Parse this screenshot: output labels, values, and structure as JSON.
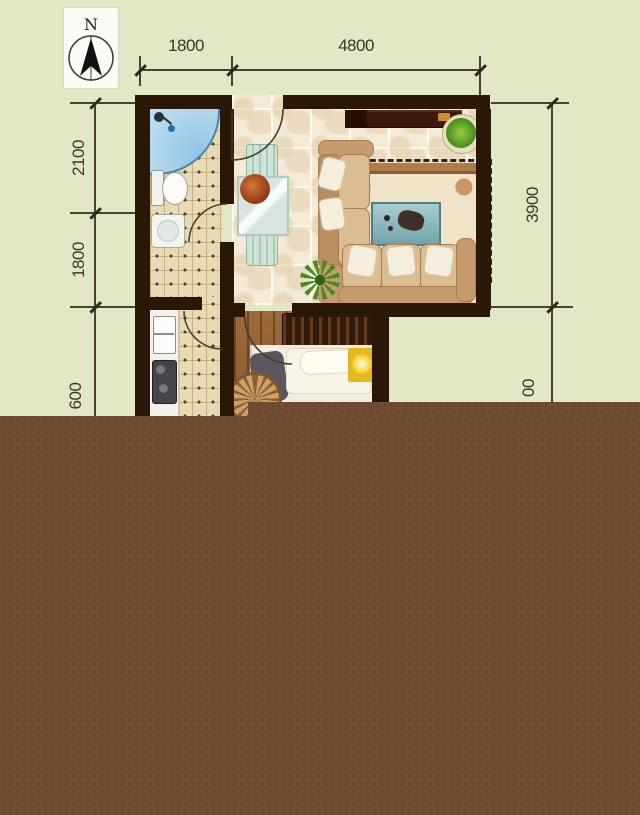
{
  "compass": {
    "label": "N",
    "icon": "north-arrow-icon"
  },
  "dimensions": {
    "top": [
      {
        "label": "1800"
      },
      {
        "label": "4800"
      }
    ],
    "left": [
      {
        "label": "2100"
      },
      {
        "label": "1800"
      },
      {
        "label": "600"
      }
    ],
    "right": [
      {
        "label": "3900"
      },
      {
        "label": "00"
      }
    ]
  },
  "colors": {
    "background": "#e2e7c6",
    "wall": "#2b1708",
    "overlay_brown": "#6f4c32",
    "dimension_ink": "#4a4134",
    "shower_blue": "#aed6ea",
    "sofa_tan": "#c59b6e",
    "rug_cream": "#f0e3c8",
    "rug_border": "#aa7d4a",
    "coffee_table_teal": "#8fb9c0",
    "tv_cabinet_maroon": "#40170c",
    "bedroom_wood": "#96633a",
    "nightstand_yellow": "#e6b81c",
    "plant_green": "#5f9e2f"
  },
  "furniture_icons": [
    "shower",
    "toilet",
    "washbasin",
    "kitchen-counter",
    "sink",
    "stove",
    "dining-chair",
    "dining-table",
    "flower-centerpiece",
    "tv-cabinet",
    "potted-plant",
    "rug",
    "coffee-table",
    "sofa",
    "palm-plant",
    "headboard",
    "bed",
    "pillow",
    "nightstand-lamp",
    "wicker-chair"
  ]
}
